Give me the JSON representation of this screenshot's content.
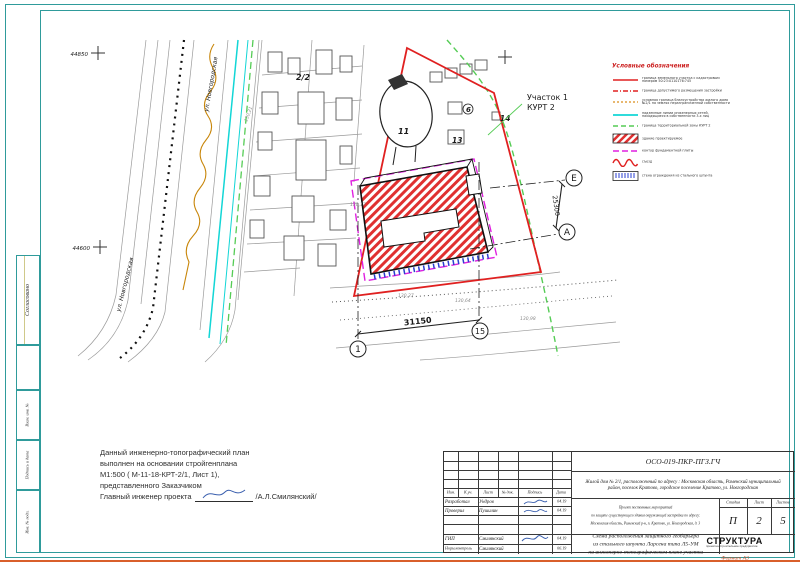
{
  "page": {
    "format_label": "Формат А3"
  },
  "margin": {
    "labels": [
      "Согласовано",
      "Взам. инв. №",
      "Подпись и дата",
      "Инв. № подл."
    ]
  },
  "map": {
    "coord_top": "44850",
    "coord_mid": "44600",
    "street": "ул. Новгородская",
    "parcel_label": "2/2",
    "pond_label": "11",
    "bld6": "6",
    "bld13": "13",
    "bld14": "14",
    "site_label_1": "Участок 1",
    "site_label_2": "КУРТ 2",
    "axis_1": "1",
    "axis_15": "15",
    "axis_E": "Е",
    "axis_A": "А",
    "dim_h": "31150",
    "dim_v": "25300",
    "elev": [
      "130,21",
      "130,17",
      "130,27",
      "130,64",
      "130,98"
    ]
  },
  "legend": {
    "title": "Условные обозначения",
    "items": [
      {
        "l1": "граница земельного участка с кадастровым",
        "l2": "номером 50:23:0110176:745"
      },
      {
        "l1": "граница допустимого размещения застройки",
        "l2": ""
      },
      {
        "l1": "условная граница благоустройства жилого дома",
        "l2": "№2/1 на землях неразграниченной собственности"
      },
      {
        "l1": "надземные линии инженерных сетей,",
        "l2": "находящиеся в собственности 3-х лиц"
      },
      {
        "l1": "граница территориальной зоны КУРТ 2",
        "l2": ""
      },
      {
        "l1": "здание проектируемое",
        "l2": ""
      },
      {
        "l1": "контур фундаментной плиты",
        "l2": ""
      },
      {
        "l1": "съезд",
        "l2": ""
      },
      {
        "l1": "стена ограждения из стального шпунта",
        "l2": ""
      }
    ]
  },
  "notes": {
    "line1": "Данный инженерно-топографический план",
    "line2": "выполнен на основании стройгенплана",
    "line3": "М1:500 ( М-11-18-КРТ-2/1, Лист 1),",
    "line4": "представленного Заказчиком",
    "line5a": "Главный инженер проекта",
    "line5b": "/А.Л.Смилянский/"
  },
  "titleblock": {
    "code": "ОСО-019-ПКР-ПГЗ.ГЧ",
    "address_line1": "Жилой дом № 2/1, расположенный по адресу : Московская область, Раменский муниципальный",
    "address_line2": "район, поселок Кратово, городское поселение Кратово, ул. Новгородская",
    "header_cols": [
      "Изм.",
      "К.уч.",
      "Лист",
      "№ док.",
      "Подпись",
      "Дата"
    ],
    "rows": [
      {
        "role": "Разработал",
        "name": "Ундров",
        "date": "04.19"
      },
      {
        "role": "Проверил",
        "name": "Пушилин",
        "date": "04.19"
      },
      {
        "role": "ГИП",
        "name": "Смилянский",
        "date": "04.19"
      },
      {
        "role": "Норм.контроль",
        "name": "Смилянский",
        "date": "06.19"
      }
    ],
    "project_line1": "Проект постоянных мероприятий",
    "project_line2": "по защите существующего здания окружающей застройки по адресу:",
    "project_line3": "Московская область, Раменский р-н, п. Кратово, ул. Новгородская, д. 3",
    "stage_headers": [
      "Стадия",
      "Лист",
      "Листов"
    ],
    "stage_values": [
      "П",
      "2",
      "5"
    ],
    "scheme_line1": "Схема расположения защитного геобарьера",
    "scheme_line2": "из стального шпунта Ларсена типа Л5-УМ",
    "scheme_line3": "на инженерно-топографическом плане участка",
    "logo": {
      "name": "СТРУКТУРА",
      "tagline": "проектно-строительное предприятие"
    }
  },
  "colors": {
    "frame_teal": "#2f9b9b",
    "boundary_red": "#e02020",
    "foundation_magenta": "#e020e0",
    "utility_cyan": "#12d6d6",
    "kurt_green": "#55cc55",
    "gas_orange": "#c8860a",
    "pile_blue": "#2a3fd0",
    "format_orange": "#d95f2b"
  }
}
